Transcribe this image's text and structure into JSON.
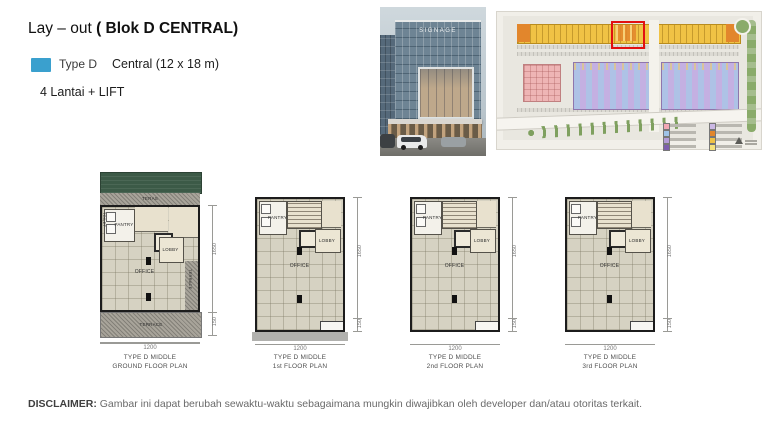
{
  "colors": {
    "type_d_swatch": "#3aa0ce",
    "highlight_box": "#e21010",
    "canopy_green": "#3c5a47",
    "plan_floor": "#d6d2c2",
    "siteplan_yellow": "#f0c245",
    "siteplan_orange": "#e2862c",
    "siteplan_purple": "#b49bd8",
    "siteplan_pink": "#eeb5b5"
  },
  "header": {
    "title_prefix": "Lay – out ",
    "title_bold": "( Blok D CENTRAL)",
    "type_label": "Type D",
    "type_value": "Central (12 x 18 m)",
    "floors_note": "4 Lantai + LIFT"
  },
  "render": {
    "signage": "SIGNAGE"
  },
  "rooms": {
    "toilet": "TOILET",
    "pantry": "PANTRY",
    "lobby": "LOBBY",
    "office": "OFFICE",
    "teras": "TERAS",
    "terrace": "TERRACE"
  },
  "dims": {
    "width": "1200",
    "depth": "1650",
    "front": "150"
  },
  "plans": [
    {
      "line1": "TYPE D MIDDLE",
      "line2": "GROUND FLOOR PLAN"
    },
    {
      "line1": "TYPE D MIDDLE",
      "line2": "1st FLOOR PLAN"
    },
    {
      "line1": "TYPE D MIDDLE",
      "line2": "2nd FLOOR PLAN"
    },
    {
      "line1": "TYPE D MIDDLE",
      "line2": "3rd FLOOR PLAN"
    }
  ],
  "disclaimer": {
    "label": "DISCLAIMER:",
    "text": " Gambar ini dapat berubah sewaktu-waktu sebagaimana mungkin diwajibkan oleh developer dan/atau otoritas terkait."
  }
}
